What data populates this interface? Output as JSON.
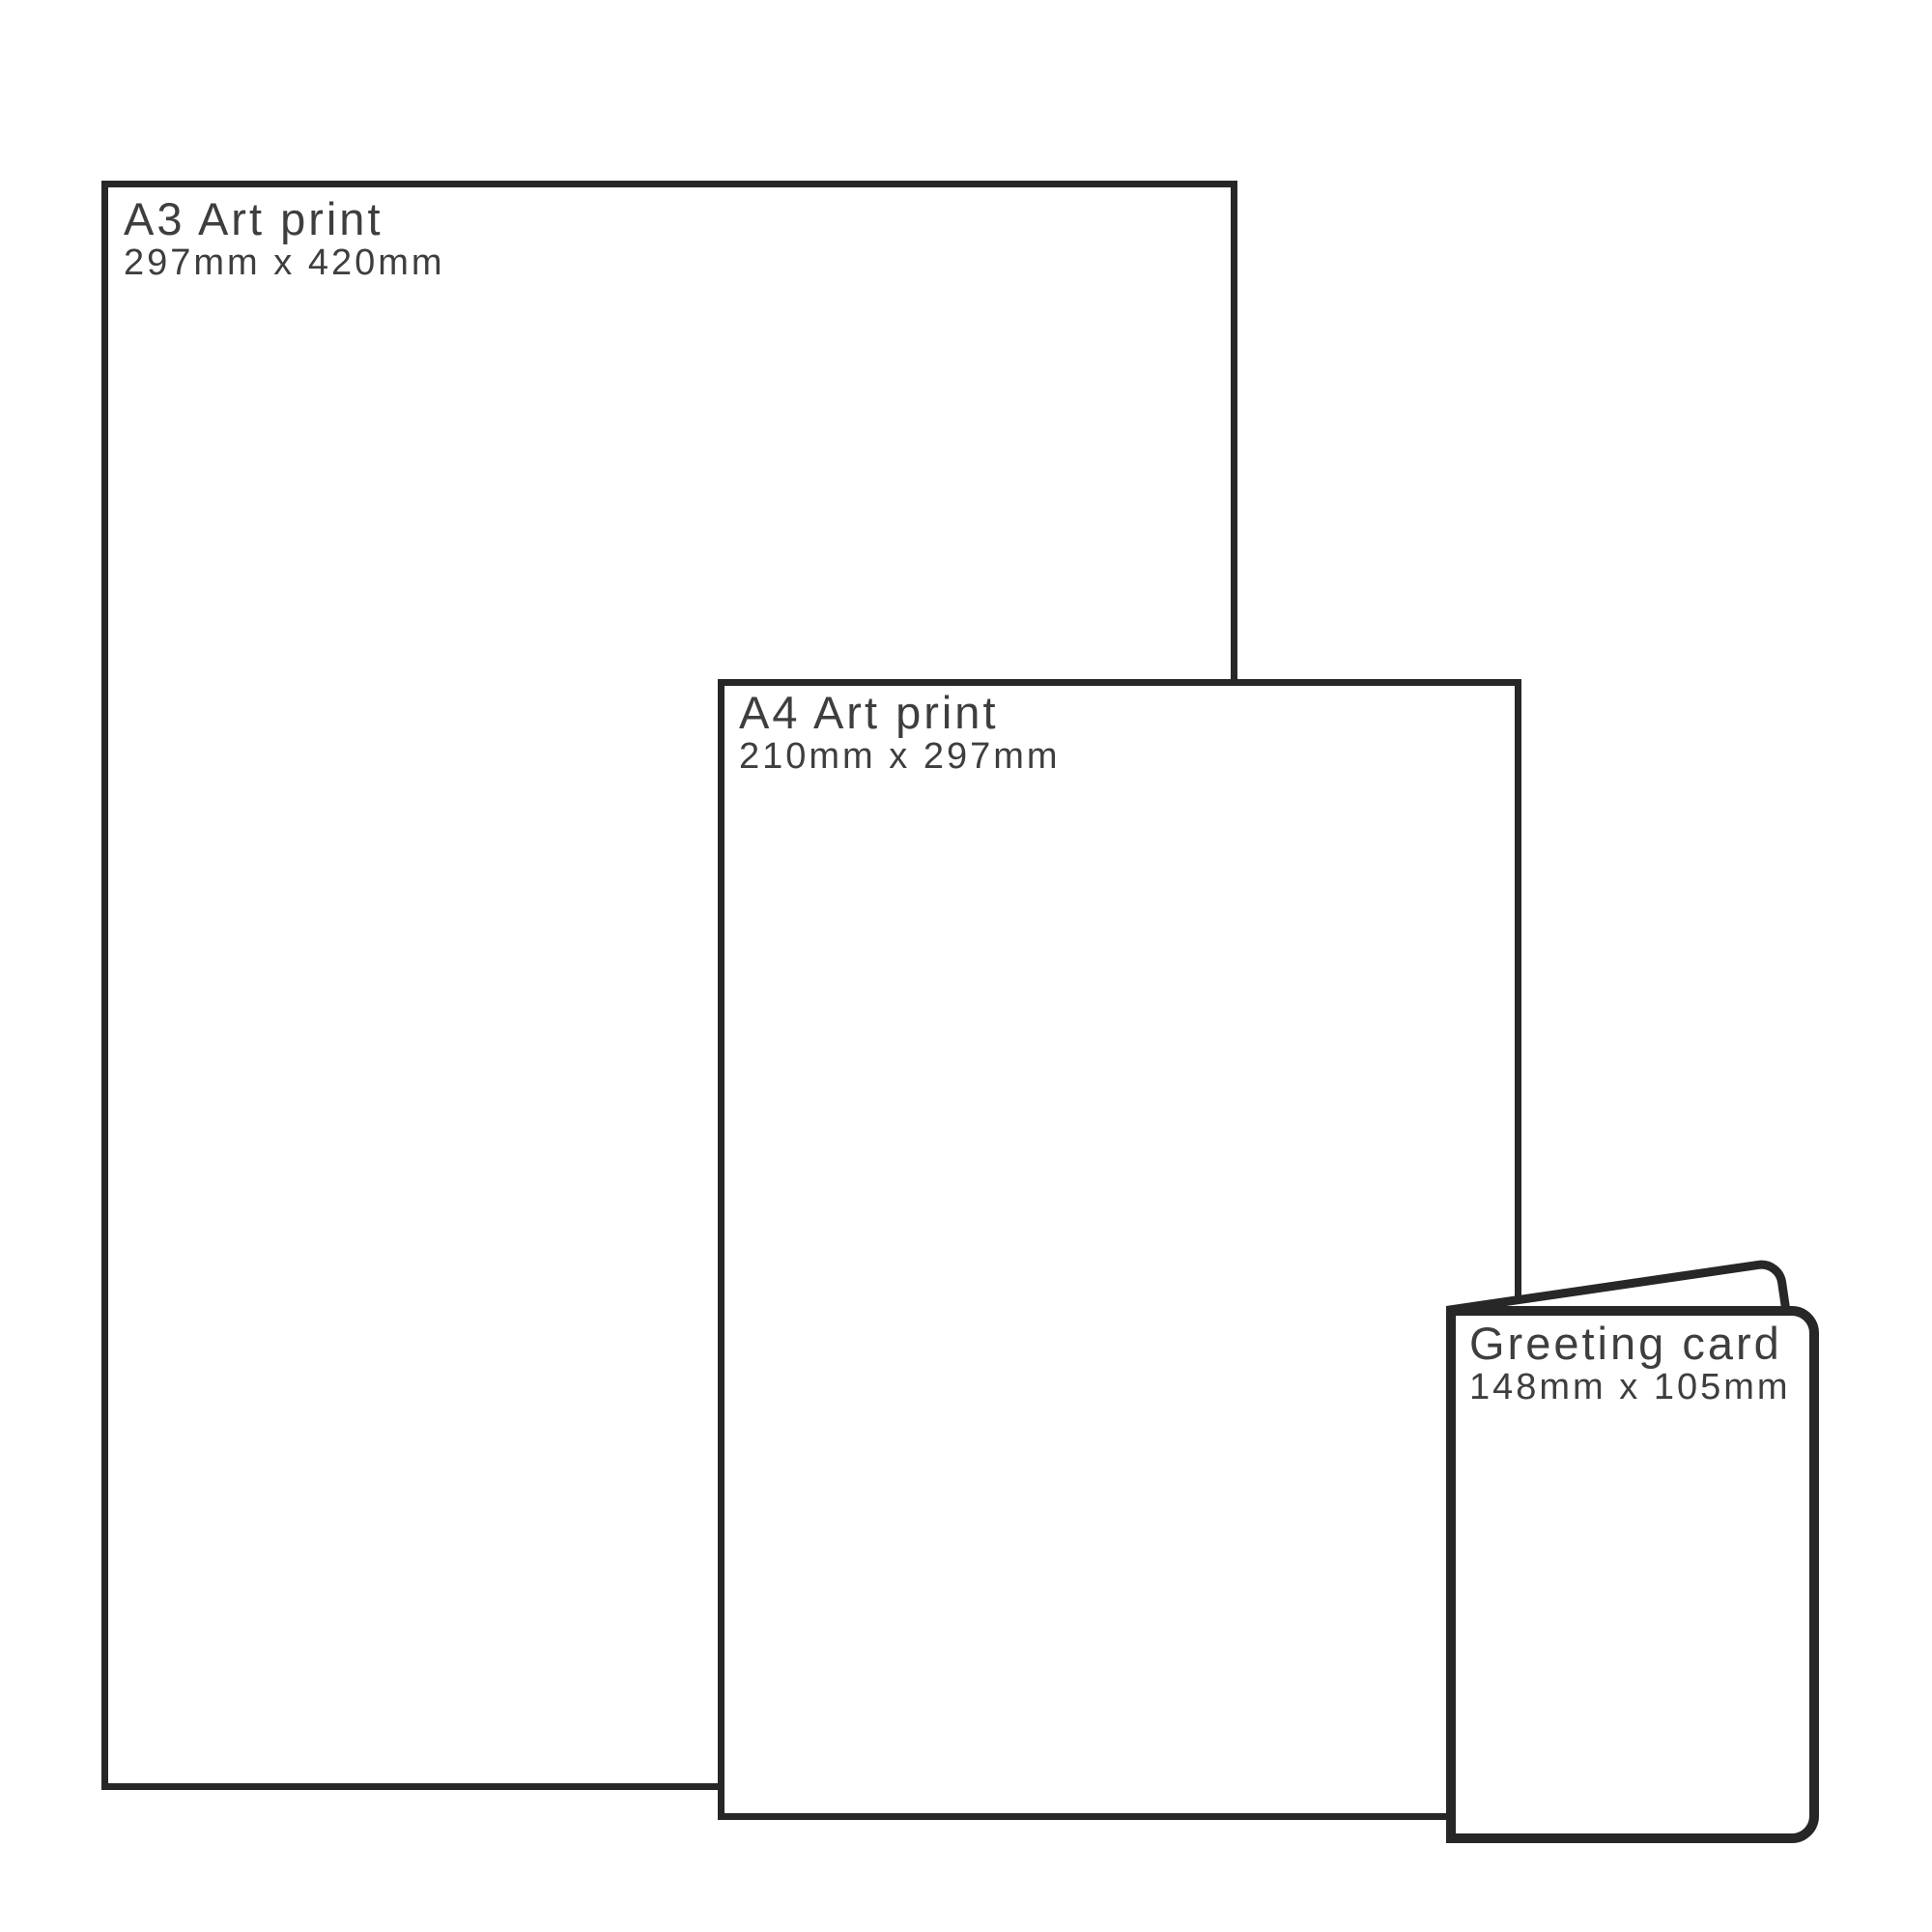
{
  "diagram": {
    "description": "Print size comparison diagram",
    "colors": {
      "outline": "#272727",
      "text": "#3e3e3e",
      "background": "#ffffff"
    }
  },
  "items": [
    {
      "id": "a3-print",
      "title": "A3 Art print",
      "dimensions": "297mm x 420mm"
    },
    {
      "id": "a4-print",
      "title": "A4 Art print",
      "dimensions": "210mm x 297mm"
    },
    {
      "id": "greeting-card",
      "title": "Greeting card",
      "dimensions": "148mm x 105mm"
    }
  ]
}
